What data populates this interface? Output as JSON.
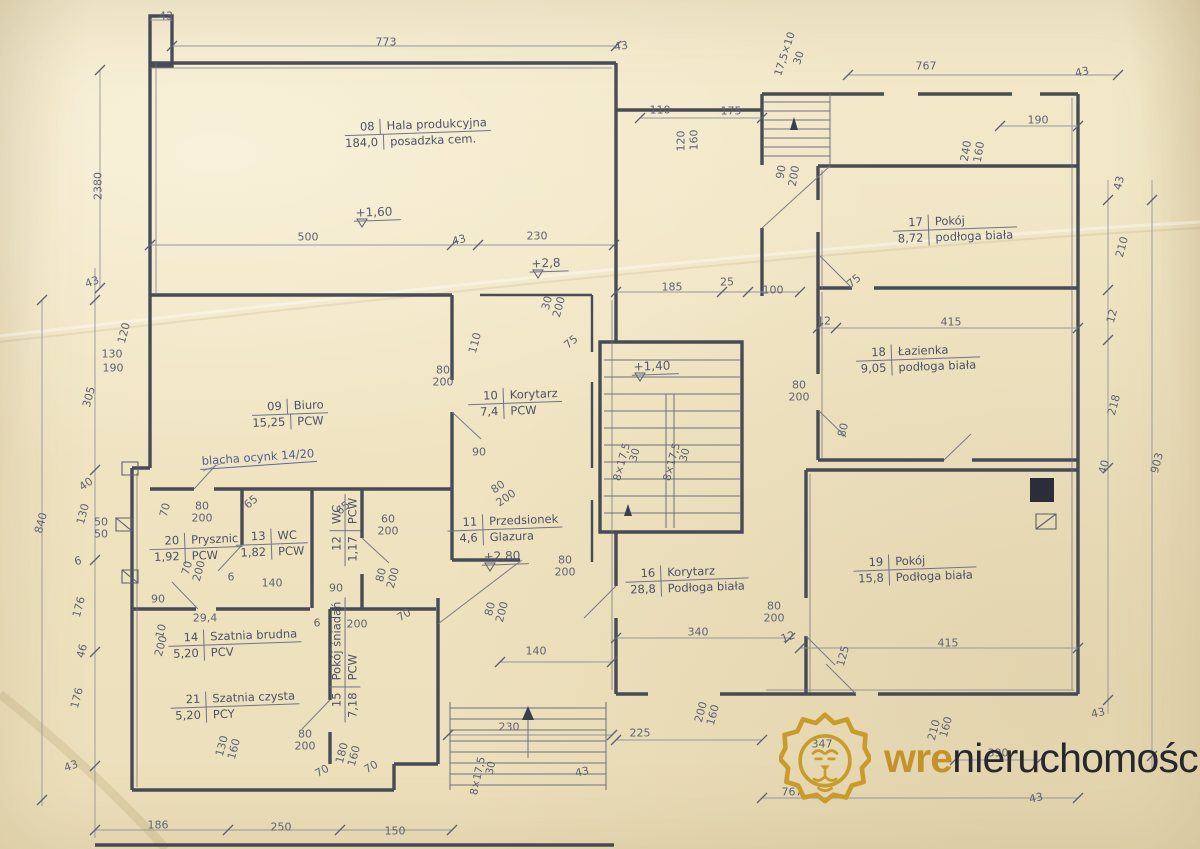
{
  "meta": {
    "document_type": "architectural floor plan scan",
    "paper_color": "#f0e4c2",
    "wall_color": "#3a3e4d",
    "pencil_color": "#5e6376",
    "gold_accent": "#c3922a"
  },
  "watermark": {
    "logo": "lion-icon",
    "brand_bold": "wre",
    "brand_rest": "nieruchomości"
  },
  "rooms": [
    {
      "id": "08",
      "name": "Hala produkcyjna",
      "area": "184,0",
      "floor": "posadzka cem.",
      "x": 418,
      "y": 133,
      "rot": -2
    },
    {
      "id": "09",
      "name": "Biuro",
      "area": "15,25",
      "floor": "PCW",
      "x": 290,
      "y": 414,
      "rot": -2
    },
    {
      "id": "10",
      "name": "Korytarz",
      "area": "7,4",
      "floor": "PCW",
      "x": 515,
      "y": 403,
      "rot": -2
    },
    {
      "id": "11",
      "name": "Przedsionek",
      "area": "4,6",
      "floor": "Glazura",
      "x": 505,
      "y": 529,
      "rot": -2
    },
    {
      "id": "12",
      "name": "WC",
      "area": "1,17",
      "floor": "PCW",
      "x": 345,
      "y": 530,
      "rot": -90
    },
    {
      "id": "13",
      "name": "WC",
      "area": "1,82",
      "floor": "PCW",
      "x": 272,
      "y": 544,
      "rot": -2
    },
    {
      "id": "14",
      "name": "Szatnia brudna",
      "area": "5,20",
      "floor": "PCV",
      "x": 235,
      "y": 644,
      "rot": -2
    },
    {
      "id": "15",
      "name": "Pokój śniadań",
      "area": "7,18",
      "floor": "PCW",
      "x": 345,
      "y": 660,
      "rot": -90
    },
    {
      "id": "16",
      "name": "Korytarz",
      "area": "28,8",
      "floor": "Podłoga biała",
      "x": 687,
      "y": 580,
      "rot": -2
    },
    {
      "id": "17",
      "name": "Pokój",
      "area": "8,72",
      "floor": "podłoga biała",
      "x": 955,
      "y": 229,
      "rot": -2
    },
    {
      "id": "18",
      "name": "Łazienka",
      "area": "9,05",
      "floor": "podłoga biała",
      "x": 918,
      "y": 359,
      "rot": -2
    },
    {
      "id": "19",
      "name": "Pokój",
      "area": "15,8",
      "floor": "Podłoga biała",
      "x": 915,
      "y": 569,
      "rot": -2
    },
    {
      "id": "20",
      "name": "Prysznic",
      "area": "1,92",
      "floor": "PCW",
      "x": 196,
      "y": 548,
      "rot": -2
    },
    {
      "id": "21",
      "name": "Szatnia czysta",
      "area": "5,20",
      "floor": "PCY",
      "x": 235,
      "y": 706,
      "rot": -2
    }
  ],
  "levels": [
    {
      "t": "+1,60",
      "x": 377,
      "y": 213
    },
    {
      "t": "+2,8",
      "x": 549,
      "y": 264
    },
    {
      "t": "+1,40",
      "x": 655,
      "y": 367
    },
    {
      "t": "+2,80",
      "x": 505,
      "y": 557
    }
  ],
  "annotations": [
    {
      "t": "blacha ocynk 14/20",
      "x": 258,
      "y": 458,
      "r": -4
    }
  ],
  "stair_labels": [
    {
      "t": "17,5×10",
      "x": 785,
      "y": 54,
      "r": -72
    },
    {
      "t": "30",
      "x": 799,
      "y": 58,
      "r": -72
    },
    {
      "t": "8×17,5",
      "x": 622,
      "y": 462,
      "r": -75
    },
    {
      "t": "30",
      "x": 635,
      "y": 455,
      "r": -75
    },
    {
      "t": "8×17,5",
      "x": 672,
      "y": 462,
      "r": -75
    },
    {
      "t": "30",
      "x": 685,
      "y": 455,
      "r": -75
    },
    {
      "t": "8×17,5",
      "x": 478,
      "y": 776,
      "r": -78
    },
    {
      "t": "30",
      "x": 491,
      "y": 768,
      "r": -78
    }
  ],
  "dimensions": [
    {
      "t": "43",
      "x": 166,
      "y": 16,
      "r": 0
    },
    {
      "t": "773",
      "x": 386,
      "y": 42,
      "r": 0
    },
    {
      "t": "43",
      "x": 621,
      "y": 46,
      "r": -8
    },
    {
      "t": "767",
      "x": 926,
      "y": 66,
      "r": 0
    },
    {
      "t": "43",
      "x": 1082,
      "y": 72,
      "r": -12
    },
    {
      "t": "110",
      "x": 660,
      "y": 110,
      "r": 0
    },
    {
      "t": "175",
      "x": 731,
      "y": 111,
      "r": 0
    },
    {
      "t": "190",
      "x": 1038,
      "y": 120,
      "r": 0
    },
    {
      "t": "120",
      "x": 681,
      "y": 141,
      "r": -90
    },
    {
      "t": "160",
      "x": 694,
      "y": 140,
      "r": -90
    },
    {
      "t": "90",
      "x": 781,
      "y": 172,
      "r": -80
    },
    {
      "t": "200",
      "x": 794,
      "y": 176,
      "r": -80
    },
    {
      "t": "240",
      "x": 966,
      "y": 151,
      "r": -80
    },
    {
      "t": "160",
      "x": 979,
      "y": 152,
      "r": -80
    },
    {
      "t": "2380",
      "x": 98,
      "y": 186,
      "r": -90
    },
    {
      "t": "43",
      "x": 1119,
      "y": 183,
      "r": -75
    },
    {
      "t": "210",
      "x": 1122,
      "y": 247,
      "r": -75
    },
    {
      "t": "12",
      "x": 1112,
      "y": 316,
      "r": -75
    },
    {
      "t": "218",
      "x": 1114,
      "y": 405,
      "r": -75
    },
    {
      "t": "40",
      "x": 1104,
      "y": 467,
      "r": -75
    },
    {
      "t": "903",
      "x": 1157,
      "y": 463,
      "r": -75
    },
    {
      "t": "43",
      "x": 92,
      "y": 282,
      "r": -20
    },
    {
      "t": "130",
      "x": 112,
      "y": 354,
      "r": 0
    },
    {
      "t": "190",
      "x": 113,
      "y": 368,
      "r": 0
    },
    {
      "t": "120",
      "x": 124,
      "y": 333,
      "r": -75
    },
    {
      "t": "305",
      "x": 89,
      "y": 397,
      "r": -75
    },
    {
      "t": "40",
      "x": 86,
      "y": 484,
      "r": -35
    },
    {
      "t": "130",
      "x": 83,
      "y": 514,
      "r": -75
    },
    {
      "t": "50",
      "x": 101,
      "y": 522,
      "r": 0
    },
    {
      "t": "50",
      "x": 101,
      "y": 534,
      "r": 0
    },
    {
      "t": "840",
      "x": 41,
      "y": 523,
      "r": -75
    },
    {
      "t": "6",
      "x": 78,
      "y": 561,
      "r": -15
    },
    {
      "t": "176",
      "x": 79,
      "y": 607,
      "r": -75
    },
    {
      "t": "46",
      "x": 82,
      "y": 651,
      "r": -75
    },
    {
      "t": "176",
      "x": 77,
      "y": 698,
      "r": -75
    },
    {
      "t": "43",
      "x": 71,
      "y": 766,
      "r": -20
    },
    {
      "t": "500",
      "x": 308,
      "y": 237,
      "r": 0
    },
    {
      "t": "43",
      "x": 459,
      "y": 240,
      "r": -15
    },
    {
      "t": "230",
      "x": 537,
      "y": 236,
      "r": 0
    },
    {
      "t": "185",
      "x": 672,
      "y": 287,
      "r": 0
    },
    {
      "t": "25",
      "x": 727,
      "y": 282,
      "r": 0
    },
    {
      "t": "100",
      "x": 773,
      "y": 290,
      "r": 0
    },
    {
      "t": "30",
      "x": 547,
      "y": 303,
      "r": -75
    },
    {
      "t": "200",
      "x": 559,
      "y": 307,
      "r": -75
    },
    {
      "t": "75",
      "x": 571,
      "y": 342,
      "r": -40
    },
    {
      "t": "110",
      "x": 475,
      "y": 343,
      "r": -75
    },
    {
      "t": "80",
      "x": 443,
      "y": 370,
      "r": 0
    },
    {
      "t": "200",
      "x": 443,
      "y": 382,
      "r": 0
    },
    {
      "t": "12",
      "x": 824,
      "y": 321,
      "r": 0
    },
    {
      "t": "415",
      "x": 951,
      "y": 322,
      "r": 0
    },
    {
      "t": "75",
      "x": 854,
      "y": 281,
      "r": -40
    },
    {
      "t": "80",
      "x": 799,
      "y": 385,
      "r": 0
    },
    {
      "t": "200",
      "x": 799,
      "y": 397,
      "r": 0
    },
    {
      "t": "90",
      "x": 479,
      "y": 452,
      "r": 0
    },
    {
      "t": "80",
      "x": 843,
      "y": 430,
      "r": -75
    },
    {
      "t": "80",
      "x": 498,
      "y": 487,
      "r": -35
    },
    {
      "t": "200",
      "x": 506,
      "y": 498,
      "r": -35
    },
    {
      "t": "70",
      "x": 165,
      "y": 510,
      "r": -75
    },
    {
      "t": "80",
      "x": 202,
      "y": 506,
      "r": 0
    },
    {
      "t": "200",
      "x": 202,
      "y": 518,
      "r": 0
    },
    {
      "t": "65",
      "x": 251,
      "y": 502,
      "r": -40
    },
    {
      "t": "65",
      "x": 343,
      "y": 508,
      "r": -40
    },
    {
      "t": "60",
      "x": 388,
      "y": 519,
      "r": 0
    },
    {
      "t": "200",
      "x": 388,
      "y": 531,
      "r": 0
    },
    {
      "t": "70",
      "x": 187,
      "y": 568,
      "r": -75
    },
    {
      "t": "200",
      "x": 199,
      "y": 571,
      "r": -75
    },
    {
      "t": "6",
      "x": 231,
      "y": 577,
      "r": 0
    },
    {
      "t": "140",
      "x": 272,
      "y": 583,
      "r": 0
    },
    {
      "t": "90",
      "x": 336,
      "y": 588,
      "r": 0
    },
    {
      "t": "80",
      "x": 381,
      "y": 575,
      "r": -75
    },
    {
      "t": "200",
      "x": 393,
      "y": 578,
      "r": -75
    },
    {
      "t": "90",
      "x": 158,
      "y": 599,
      "r": 0
    },
    {
      "t": "29,4",
      "x": 205,
      "y": 618,
      "r": 0
    },
    {
      "t": "6",
      "x": 317,
      "y": 623,
      "r": 0
    },
    {
      "t": "200",
      "x": 357,
      "y": 624,
      "r": 0
    },
    {
      "t": "10",
      "x": 161,
      "y": 631,
      "r": -75
    },
    {
      "t": "200",
      "x": 161,
      "y": 646,
      "r": -75
    },
    {
      "t": "70",
      "x": 404,
      "y": 615,
      "r": -30
    },
    {
      "t": "80",
      "x": 490,
      "y": 609,
      "r": -75
    },
    {
      "t": "200",
      "x": 502,
      "y": 612,
      "r": -75
    },
    {
      "t": "80",
      "x": 565,
      "y": 560,
      "r": 0
    },
    {
      "t": "200",
      "x": 565,
      "y": 572,
      "r": 0
    },
    {
      "t": "140",
      "x": 536,
      "y": 651,
      "r": 0
    },
    {
      "t": "340",
      "x": 698,
      "y": 632,
      "r": 0
    },
    {
      "t": "12",
      "x": 788,
      "y": 637,
      "r": -20
    },
    {
      "t": "125",
      "x": 843,
      "y": 656,
      "r": -75
    },
    {
      "t": "415",
      "x": 948,
      "y": 643,
      "r": 0
    },
    {
      "t": "80",
      "x": 774,
      "y": 606,
      "r": 0
    },
    {
      "t": "200",
      "x": 774,
      "y": 618,
      "r": 0
    },
    {
      "t": "130",
      "x": 222,
      "y": 746,
      "r": -75
    },
    {
      "t": "160",
      "x": 234,
      "y": 749,
      "r": -75
    },
    {
      "t": "80",
      "x": 305,
      "y": 734,
      "r": 0
    },
    {
      "t": "200",
      "x": 305,
      "y": 746,
      "r": 0
    },
    {
      "t": "180",
      "x": 342,
      "y": 753,
      "r": -75
    },
    {
      "t": "160",
      "x": 354,
      "y": 756,
      "r": -75
    },
    {
      "t": "70",
      "x": 322,
      "y": 771,
      "r": -30
    },
    {
      "t": "70",
      "x": 371,
      "y": 767,
      "r": -30
    },
    {
      "t": "230",
      "x": 509,
      "y": 727,
      "r": 0
    },
    {
      "t": "225",
      "x": 640,
      "y": 733,
      "r": 0
    },
    {
      "t": "200",
      "x": 701,
      "y": 712,
      "r": -75
    },
    {
      "t": "160",
      "x": 713,
      "y": 715,
      "r": -75
    },
    {
      "t": "43",
      "x": 582,
      "y": 772,
      "r": -12
    },
    {
      "t": "767",
      "x": 792,
      "y": 792,
      "r": 0
    },
    {
      "t": "347",
      "x": 822,
      "y": 744,
      "r": 0
    },
    {
      "t": "210",
      "x": 934,
      "y": 730,
      "r": -75
    },
    {
      "t": "160",
      "x": 946,
      "y": 727,
      "r": -75
    },
    {
      "t": "390",
      "x": 998,
      "y": 753,
      "r": 0
    },
    {
      "t": "43",
      "x": 1036,
      "y": 798,
      "r": -12
    },
    {
      "t": "43",
      "x": 1098,
      "y": 713,
      "r": -12
    },
    {
      "t": "186",
      "x": 158,
      "y": 825,
      "r": 0
    },
    {
      "t": "250",
      "x": 281,
      "y": 827,
      "r": 0
    },
    {
      "t": "150",
      "x": 395,
      "y": 831,
      "r": 0
    }
  ]
}
